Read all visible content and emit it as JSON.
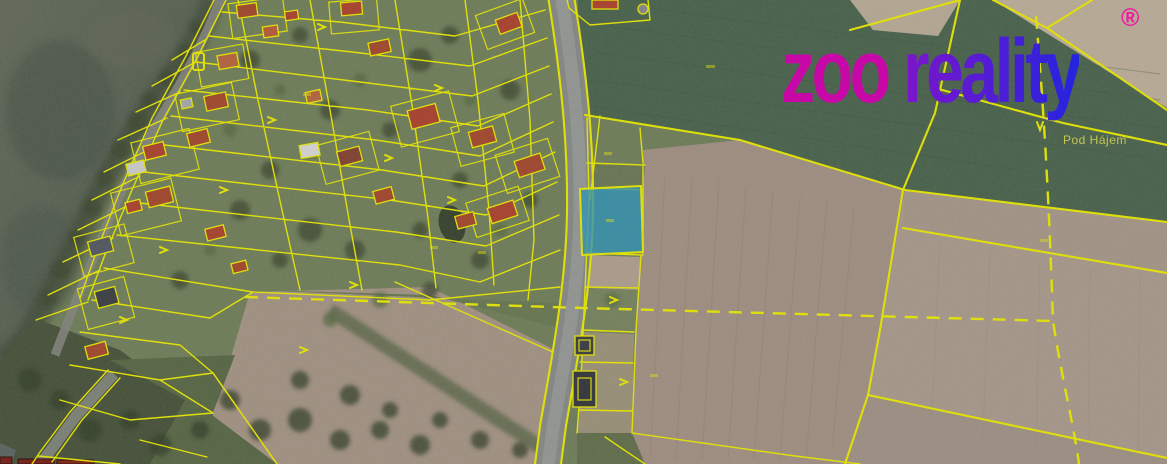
{
  "brand": {
    "name_part1": "zoo",
    "name_part2": "reality",
    "registered_mark": "®"
  },
  "map": {
    "place_label": "Pod Hájem",
    "highlighted_parcel": {
      "fill_color": "#2d9dc6",
      "outline_color": "#f7f700",
      "description": "selected land plot east of the road"
    },
    "parcel_line_color": "#f7f700"
  },
  "theme": {
    "line": "#f7f700",
    "highlight": "#2d9dc6",
    "logo-zoo": "#c808a6",
    "logo-re1": "#7d15cb",
    "logo-re2": "#2424df",
    "logo-reg": "#ef19a0",
    "label": "#d3cf52"
  }
}
